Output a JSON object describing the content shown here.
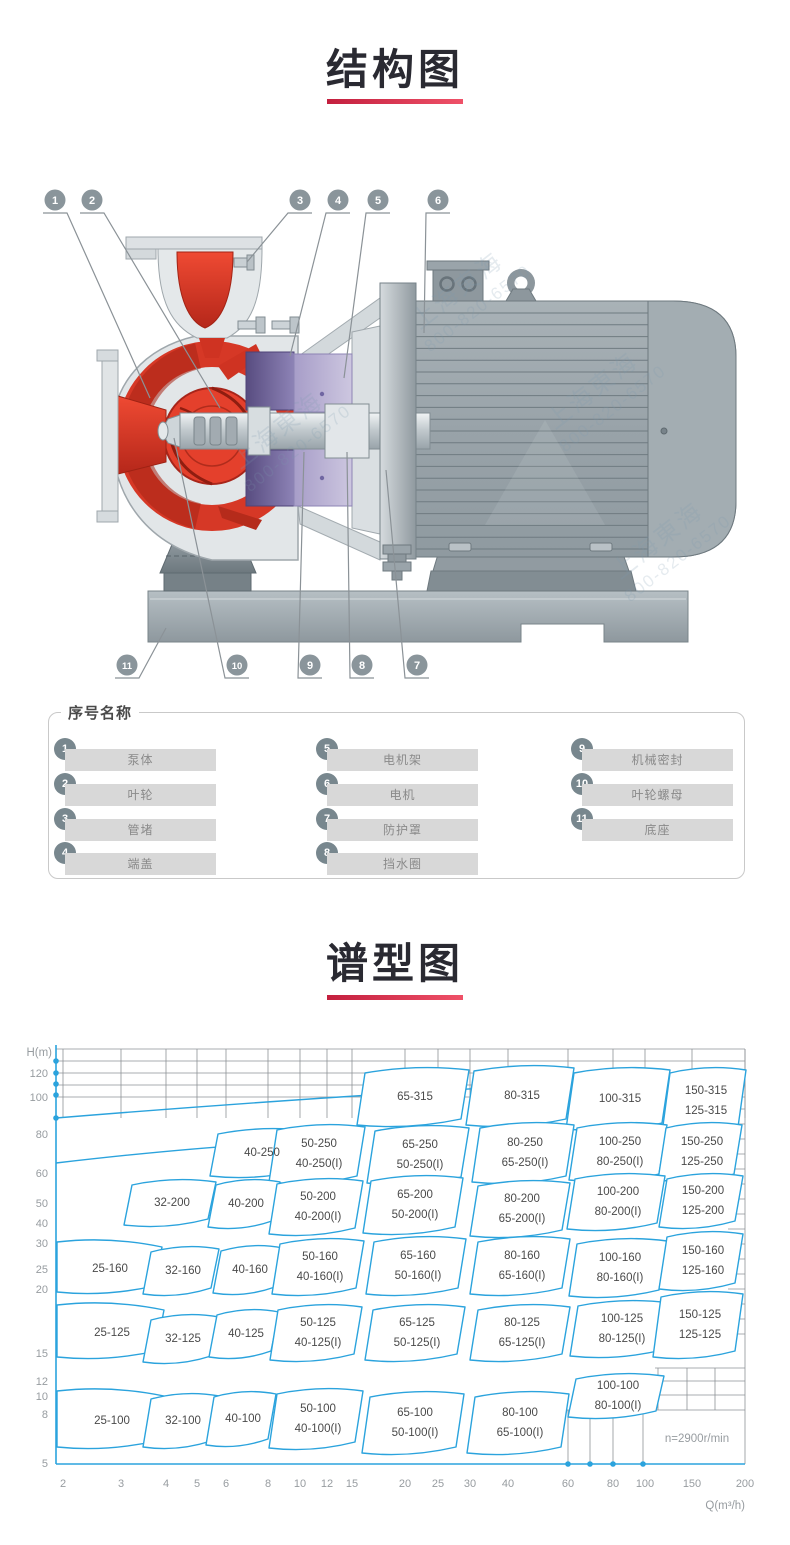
{
  "colors": {
    "accent_red": "#c31f3e",
    "accent_red_light": "#ef5168",
    "chart_blue": "#2ba3dd",
    "grid_gray": "#8d9296",
    "region_label": "#4a4a4a",
    "axis_label": "#979ca0",
    "callout_gray": "#8a959b",
    "pump_red": "#d63826",
    "seal_purple": "#6a5e92",
    "metal_gray": "#9aa4aa"
  },
  "structure_section": {
    "title": "结构图",
    "watermark_cn": "上海東海",
    "watermark_phone": "800-820-6570",
    "callouts": [
      {
        "n": "1",
        "cx": 55,
        "cy": 200,
        "tx": 150,
        "ty": 398
      },
      {
        "n": "2",
        "cx": 92,
        "cy": 200,
        "tx": 220,
        "ty": 408
      },
      {
        "n": "3",
        "cx": 300,
        "cy": 200,
        "tx": 247,
        "ty": 262
      },
      {
        "n": "4",
        "cx": 338,
        "cy": 200,
        "tx": 290,
        "ty": 356
      },
      {
        "n": "5",
        "cx": 378,
        "cy": 200,
        "tx": 344,
        "ty": 378
      },
      {
        "n": "6",
        "cx": 438,
        "cy": 200,
        "tx": 424,
        "ty": 333
      },
      {
        "n": "7",
        "cx": 417,
        "cy": 665,
        "tx": 386,
        "ty": 470
      },
      {
        "n": "8",
        "cx": 362,
        "cy": 665,
        "tx": 347,
        "ty": 452
      },
      {
        "n": "9",
        "cx": 310,
        "cy": 665,
        "tx": 304,
        "ty": 452
      },
      {
        "n": "10",
        "cx": 237,
        "cy": 665,
        "tx": 174,
        "ty": 438
      },
      {
        "n": "11",
        "cx": 127,
        "cy": 665,
        "tx": 166,
        "ty": 628
      }
    ]
  },
  "parts_panel": {
    "title": "序号名称",
    "items": [
      {
        "num": "1",
        "label": "泵体"
      },
      {
        "num": "2",
        "label": "叶轮"
      },
      {
        "num": "3",
        "label": "管堵"
      },
      {
        "num": "4",
        "label": "端盖"
      },
      {
        "num": "5",
        "label": "电机架"
      },
      {
        "num": "6",
        "label": "电机"
      },
      {
        "num": "7",
        "label": "防护罩"
      },
      {
        "num": "8",
        "label": "挡水圈"
      },
      {
        "num": "9",
        "label": "机械密封"
      },
      {
        "num": "10",
        "label": "叶轮螺母"
      },
      {
        "num": "11",
        "label": "底座"
      }
    ]
  },
  "spectrum_section": {
    "title": "谱型图"
  },
  "chart_data": {
    "type": "area",
    "subtype": "pump-model-selection-regions",
    "title": "谱型图",
    "xlabel": "Q(m³/h)",
    "ylabel": "H(m)",
    "x_scale": "log",
    "y_scale": "log",
    "xlim": [
      2,
      200
    ],
    "ylim": [
      5,
      140
    ],
    "grid": "partial-top-and-bottom-right",
    "legend_position": "none",
    "speed_annotation": "n=2900r/min",
    "x_ticks": [
      {
        "label": "2",
        "px": 63
      },
      {
        "label": "3",
        "px": 121
      },
      {
        "label": "4",
        "px": 166
      },
      {
        "label": "5",
        "px": 197
      },
      {
        "label": "6",
        "px": 226
      },
      {
        "label": "8",
        "px": 268
      },
      {
        "label": "10",
        "px": 300
      },
      {
        "label": "12",
        "px": 327
      },
      {
        "label": "15",
        "px": 352
      },
      {
        "label": "20",
        "px": 405
      },
      {
        "label": "25",
        "px": 438
      },
      {
        "label": "30",
        "px": 470
      },
      {
        "label": "40",
        "px": 508
      },
      {
        "label": "60",
        "px": 568
      },
      {
        "label": "80",
        "px": 613
      },
      {
        "label": "100",
        "px": 645
      },
      {
        "label": "150",
        "px": 692
      },
      {
        "label": "200",
        "px": 745
      }
    ],
    "y_ticks": [
      {
        "label": "120",
        "py": 1073
      },
      {
        "label": "100",
        "py": 1097
      },
      {
        "label": "80",
        "py": 1134
      },
      {
        "label": "60",
        "py": 1173
      },
      {
        "label": "50",
        "py": 1203
      },
      {
        "label": "40",
        "py": 1223
      },
      {
        "label": "30",
        "py": 1243
      },
      {
        "label": "25",
        "py": 1269
      },
      {
        "label": "20",
        "py": 1289
      },
      {
        "label": "15",
        "py": 1353
      },
      {
        "label": "12",
        "py": 1381
      },
      {
        "label": "10",
        "py": 1396
      },
      {
        "label": "8",
        "py": 1414
      },
      {
        "label": "5",
        "py": 1463
      }
    ],
    "axis_dots_y": [
      1061,
      1073,
      1084,
      1095,
      1118
    ],
    "axis_dots_x": [
      568,
      590,
      613,
      643
    ],
    "regions": [
      {
        "labels": [
          "65-315"
        ],
        "cx": 415,
        "cy": 1096,
        "w": 104,
        "h": 50,
        "qh": [
          22,
          100
        ]
      },
      {
        "labels": [
          "80-315"
        ],
        "cx": 522,
        "cy": 1095,
        "w": 100,
        "h": 52,
        "qh": [
          44,
          100
        ]
      },
      {
        "labels": [
          "100-315"
        ],
        "cx": 620,
        "cy": 1098,
        "w": 96,
        "h": 54,
        "qh": [
          86,
          100
        ]
      },
      {
        "labels": [
          "150-315",
          "125-315"
        ],
        "cx": 706,
        "cy": 1100,
        "w": 76,
        "h": 58,
        "qh": [
          150,
          100
        ]
      },
      {
        "labels": [
          "40-250"
        ],
        "cx": 262,
        "cy": 1152,
        "w": 92,
        "h": 40,
        "qh": [
          7.7,
          63
        ]
      },
      {
        "labels": [
          "50-250",
          "40-250(I)"
        ],
        "cx": 319,
        "cy": 1153,
        "w": 88,
        "h": 50,
        "qh": [
          11,
          63
        ]
      },
      {
        "labels": [
          "65-250",
          "50-250(I)"
        ],
        "cx": 420,
        "cy": 1154,
        "w": 94,
        "h": 50,
        "qh": [
          22,
          63
        ]
      },
      {
        "labels": [
          "80-250",
          "65-250(I)"
        ],
        "cx": 525,
        "cy": 1152,
        "w": 94,
        "h": 52,
        "qh": [
          45,
          63
        ]
      },
      {
        "labels": [
          "100-250",
          "80-250(I)"
        ],
        "cx": 620,
        "cy": 1151,
        "w": 90,
        "h": 50,
        "qh": [
          86,
          63
        ]
      },
      {
        "labels": [
          "150-250",
          "125-250"
        ],
        "cx": 702,
        "cy": 1151,
        "w": 76,
        "h": 50,
        "qh": [
          148,
          63
        ]
      },
      {
        "labels": [
          "32-200"
        ],
        "cx": 172,
        "cy": 1202,
        "w": 84,
        "h": 38,
        "qh": [
          4.2,
          41
        ]
      },
      {
        "labels": [
          "40-200"
        ],
        "cx": 246,
        "cy": 1203,
        "w": 64,
        "h": 40,
        "qh": [
          6.9,
          41
        ]
      },
      {
        "labels": [
          "50-200",
          "40-200(I)"
        ],
        "cx": 318,
        "cy": 1206,
        "w": 86,
        "h": 48,
        "qh": [
          11,
          41
        ]
      },
      {
        "labels": [
          "65-200",
          "50-200(I)"
        ],
        "cx": 415,
        "cy": 1204,
        "w": 92,
        "h": 50,
        "qh": [
          21,
          41
        ]
      },
      {
        "labels": [
          "80-200",
          "65-200(I)"
        ],
        "cx": 522,
        "cy": 1208,
        "w": 92,
        "h": 48,
        "qh": [
          44,
          40
        ]
      },
      {
        "labels": [
          "100-200",
          "80-200(I)"
        ],
        "cx": 618,
        "cy": 1201,
        "w": 90,
        "h": 48,
        "qh": [
          85,
          41
        ]
      },
      {
        "labels": [
          "150-200",
          "125-200"
        ],
        "cx": 703,
        "cy": 1200,
        "w": 76,
        "h": 46,
        "qh": [
          150,
          41
        ]
      },
      {
        "labels": [
          "25-160"
        ],
        "cx": 110,
        "cy": 1268,
        "w": 100,
        "h": 40,
        "flush": true,
        "qh": [
          2.8,
          24
        ]
      },
      {
        "labels": [
          "32-160"
        ],
        "cx": 183,
        "cy": 1270,
        "w": 68,
        "h": 40,
        "qh": [
          4.5,
          24
        ]
      },
      {
        "labels": [
          "40-160"
        ],
        "cx": 250,
        "cy": 1269,
        "w": 62,
        "h": 40,
        "qh": [
          7,
          24
        ]
      },
      {
        "labels": [
          "50-160",
          "40-160(I)"
        ],
        "cx": 320,
        "cy": 1266,
        "w": 84,
        "h": 48,
        "qh": [
          11,
          24
        ]
      },
      {
        "labels": [
          "65-160",
          "50-160(I)"
        ],
        "cx": 418,
        "cy": 1265,
        "w": 92,
        "h": 50,
        "qh": [
          22,
          24
        ]
      },
      {
        "labels": [
          "80-160",
          "65-160(I)"
        ],
        "cx": 522,
        "cy": 1265,
        "w": 92,
        "h": 50,
        "qh": [
          44,
          24
        ]
      },
      {
        "labels": [
          "100-160",
          "80-160(I)"
        ],
        "cx": 620,
        "cy": 1267,
        "w": 90,
        "h": 50,
        "qh": [
          86,
          24
        ]
      },
      {
        "labels": [
          "150-160",
          "125-160"
        ],
        "cx": 703,
        "cy": 1260,
        "w": 76,
        "h": 50,
        "qh": [
          150,
          25
        ]
      },
      {
        "labels": [
          "25-125"
        ],
        "cx": 112,
        "cy": 1332,
        "w": 100,
        "h": 42,
        "flush": true,
        "qh": [
          2.8,
          14
        ]
      },
      {
        "labels": [
          "32-125"
        ],
        "cx": 183,
        "cy": 1338,
        "w": 68,
        "h": 40,
        "qh": [
          4.5,
          13.5
        ]
      },
      {
        "labels": [
          "40-125"
        ],
        "cx": 246,
        "cy": 1333,
        "w": 62,
        "h": 40,
        "qh": [
          6.9,
          14
        ]
      },
      {
        "labels": [
          "50-125",
          "40-125(I)"
        ],
        "cx": 318,
        "cy": 1332,
        "w": 84,
        "h": 48,
        "qh": [
          11,
          14
        ]
      },
      {
        "labels": [
          "65-125",
          "50-125(I)"
        ],
        "cx": 417,
        "cy": 1332,
        "w": 92,
        "h": 48,
        "qh": [
          21.8,
          14
        ]
      },
      {
        "labels": [
          "80-125",
          "65-125(I)"
        ],
        "cx": 522,
        "cy": 1332,
        "w": 92,
        "h": 48,
        "qh": [
          44,
          14
        ]
      },
      {
        "labels": [
          "100-125",
          "80-125(I)"
        ],
        "cx": 622,
        "cy": 1328,
        "w": 92,
        "h": 48,
        "qh": [
          87,
          14
        ]
      },
      {
        "labels": [
          "150-125",
          "125-125"
        ],
        "cx": 700,
        "cy": 1324,
        "w": 82,
        "h": 58,
        "qh": [
          146,
          14.5
        ]
      },
      {
        "labels": [
          "25-100"
        ],
        "cx": 112,
        "cy": 1420,
        "w": 100,
        "h": 46,
        "flush": true,
        "qh": [
          2.8,
          6.7
        ]
      },
      {
        "labels": [
          "32-100"
        ],
        "cx": 183,
        "cy": 1420,
        "w": 68,
        "h": 46,
        "qh": [
          4.5,
          6.7
        ]
      },
      {
        "labels": [
          "40-100"
        ],
        "cx": 243,
        "cy": 1418,
        "w": 62,
        "h": 46,
        "qh": [
          6.8,
          6.8
        ]
      },
      {
        "labels": [
          "50-100",
          "40-100(I)"
        ],
        "cx": 318,
        "cy": 1418,
        "w": 86,
        "h": 52,
        "qh": [
          11,
          6.8
        ]
      },
      {
        "labels": [
          "65-100",
          "50-100(I)"
        ],
        "cx": 415,
        "cy": 1422,
        "w": 94,
        "h": 54,
        "qh": [
          21,
          6.6
        ]
      },
      {
        "labels": [
          "80-100",
          "65-100(I)"
        ],
        "cx": 520,
        "cy": 1422,
        "w": 94,
        "h": 54,
        "qh": [
          43,
          6.6
        ]
      },
      {
        "labels": [
          "100-100",
          "80-100(I)"
        ],
        "cx": 618,
        "cy": 1395,
        "w": 88,
        "h": 36,
        "qh": [
          85,
          8.2
        ]
      }
    ]
  }
}
